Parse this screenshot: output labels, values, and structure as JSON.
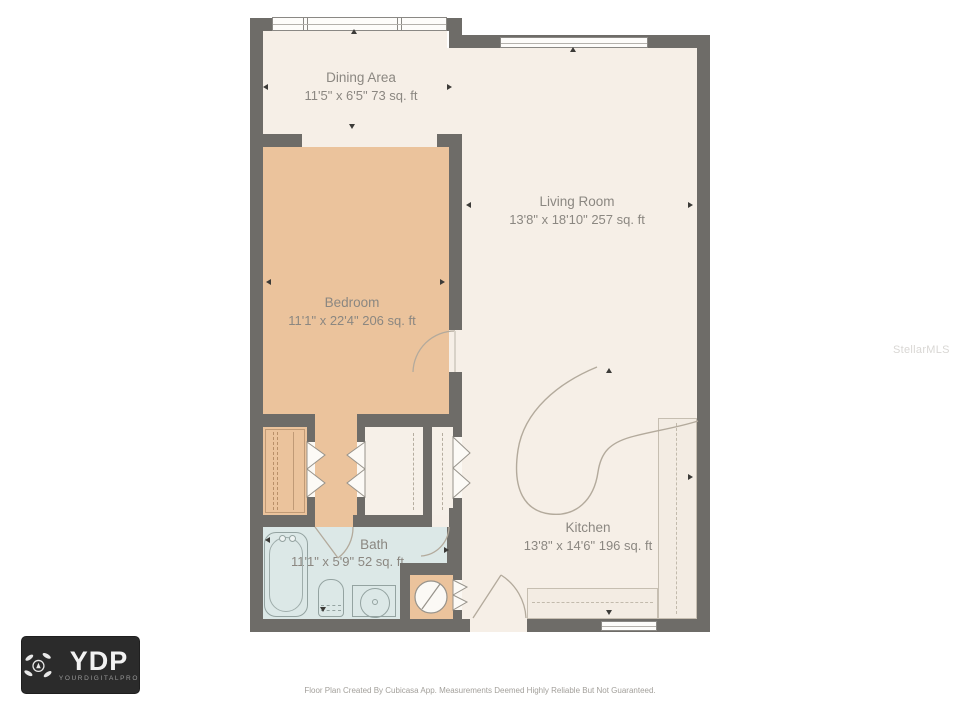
{
  "watermark": {
    "text": "StellarMLS"
  },
  "footer": {
    "disclaimer": "Floor Plan Created By Cubicasa App. Measurements Deemed Highly Reliable But Not Guaranteed."
  },
  "logo": {
    "abbr": "YDP",
    "name": "YOURDIGITALPRO",
    "icon": "drone-camera-icon"
  },
  "rooms": {
    "dining": {
      "name": "Dining Area",
      "dims": "11'5\" x 6'5\" 73 sq. ft"
    },
    "living": {
      "name": "Living Room",
      "dims": "13'8\" x 18'10\" 257 sq. ft"
    },
    "bedroom": {
      "name": "Bedroom",
      "dims": "11'1\" x 22'4\" 206 sq. ft"
    },
    "bath": {
      "name": "Bath",
      "dims": "11'1\" x 5'9\" 52 sq. ft"
    },
    "kitchen": {
      "name": "Kitchen",
      "dims": "13'8\" x 14'6\" 196 sq. ft"
    }
  },
  "fixtures": [
    "bathtub",
    "toilet",
    "vanity-sink",
    "washer",
    "wardrobe",
    "refrigerator",
    "stove-burners",
    "kitchen-double-sink",
    "kitchen-peninsula"
  ],
  "colors": {
    "wall": "#6e6c68",
    "floor": "#f6efe7",
    "bedroom_floor": "#ebc39c",
    "bath_floor": "#dce8e7",
    "label_text": "#8b8781"
  }
}
